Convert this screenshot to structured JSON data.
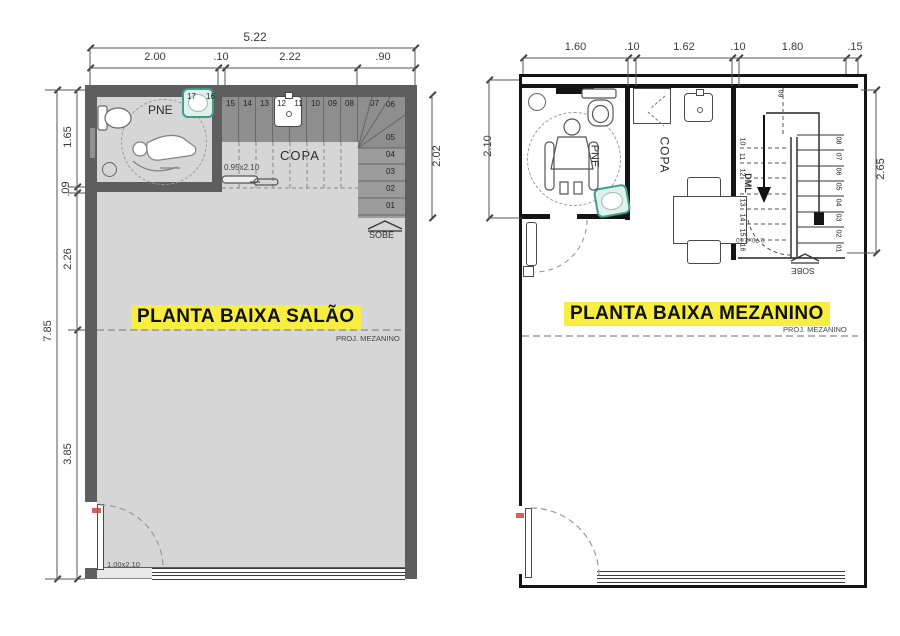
{
  "colors": {
    "wall_gray": "#5e5e5e",
    "floor_gray": "#d6d6d6",
    "stair_dark": "#8e8e8e",
    "stair_light": "#9c9c9c",
    "highlight_yellow": "#f7ee41",
    "sink_teal": "#3f9d8c",
    "door_red": "#c9493d"
  },
  "salao": {
    "title": "PLANTA BAIXA SALÃO",
    "proj_mezanino": "PROJ. MEZANINO",
    "dim_total_w": "5.22",
    "dim_w": [
      "2.00",
      ".10",
      "2.22",
      ".90"
    ],
    "dim_total_h": "7.85",
    "dim_h": [
      "1.65",
      ".09",
      "2.26",
      "3.85"
    ],
    "dim_stair": "2.02",
    "room_pne": "PNE",
    "room_copa": "COPA",
    "door_pne": "0.95x2.10",
    "door_entry": "1.00x2.10",
    "stair_direction": "SOBE",
    "treads_top": [
      "17",
      "16",
      "15",
      "14",
      "13",
      "12",
      "11",
      "10",
      "09",
      "08",
      "07"
    ],
    "treads_side": [
      "06",
      "05",
      "04",
      "03",
      "02",
      "01"
    ]
  },
  "mezanino": {
    "title": "PLANTA BAIXA MEZANINO",
    "proj_mezanino": "PROJ. MEZANINO",
    "dim_w": [
      "1.60",
      ".10",
      "1.62",
      ".10",
      "1.80",
      ".15"
    ],
    "dim_left": "2.10",
    "dim_right": "2.65",
    "room_pne": "PNE",
    "room_copa": "COPA",
    "room_dml": "DML",
    "door_stair": "0.70x2.10",
    "stair_direction": "SOBE",
    "tread_top": "09",
    "treads_under": [
      "10",
      "11",
      "12",
      "13",
      "14",
      "15",
      "16"
    ],
    "treads_main": [
      "08",
      "07",
      "06",
      "05",
      "04",
      "03",
      "02",
      "01"
    ]
  }
}
